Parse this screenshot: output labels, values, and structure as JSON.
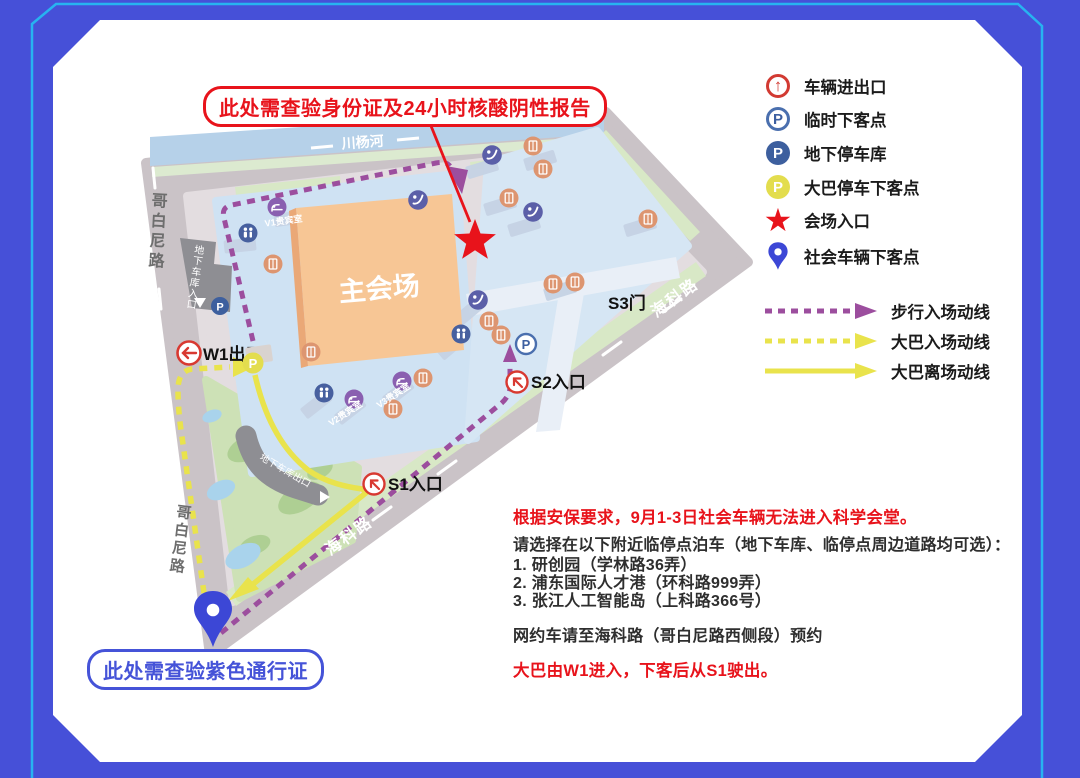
{
  "annotations": {
    "id_check": "此处需查验身份证及24小时核酸阴性报告",
    "pass_check": "此处需查验紫色通行证"
  },
  "map": {
    "river": "川杨河",
    "road_west_top": "哥白尼路",
    "road_west_bottom": "哥白尼路",
    "road_se_upper": "海科路",
    "road_se_lower": "海科路",
    "main_hall": "主会场",
    "w1": "W1出口",
    "s1": "S1入口",
    "s2": "S2入口",
    "s3": "S3门",
    "garage_in": "地下车库入口",
    "garage_out": "地下车库出口",
    "vip1": "V1贵宾室",
    "vip2": "V2贵宾室",
    "vip3": "V3贵宾室"
  },
  "icons": {
    "parking_letter": "P",
    "up_arrow": "↑",
    "star_glyph": "★",
    "names": [
      "vehicle-gate-icon",
      "temp-dropoff-icon",
      "underground-garage-icon",
      "bus-dropoff-icon",
      "venue-entrance-star-icon",
      "social-vehicle-pin-icon",
      "walk-route-arrow",
      "bus-in-route-arrow",
      "bus-out-route-arrow",
      "lounge-icon",
      "info-icon",
      "facility-icon",
      "escalator-icon",
      "map-pin-icon"
    ]
  },
  "legend": {
    "markers": [
      {
        "icon": "vehicle-gate-icon",
        "label": "车辆进出口"
      },
      {
        "icon": "temp-dropoff-icon",
        "label": "临时下客点"
      },
      {
        "icon": "underground-garage-icon",
        "label": "地下停车库"
      },
      {
        "icon": "bus-dropoff-icon",
        "label": "大巴停车下客点"
      },
      {
        "icon": "venue-entrance-star-icon",
        "label": "会场入口"
      },
      {
        "icon": "social-vehicle-pin-icon",
        "label": "社会车辆下客点"
      }
    ],
    "routes": [
      {
        "style": "dashed",
        "color": "#9c4e9e",
        "label": "步行入场动线"
      },
      {
        "style": "dashed",
        "color": "#e9e34c",
        "label": "大巴入场动线"
      },
      {
        "style": "solid",
        "color": "#e9e34c",
        "label": "大巴离场动线"
      }
    ]
  },
  "notice": {
    "security": "根据安保要求，9月1-3日社会车辆无法进入科学会堂。",
    "parking_intro": "请选择在以下附近临停点泊车（地下车库、临停点周边道路均可选）：",
    "parking_options": [
      "1. 研创园（学林路36弄）",
      "2. 浦东国际人才港（环科路999弄）",
      "3. 张江人工智能岛（上科路366号）"
    ],
    "ride_hailing": "网约车请至海科路（哥白尼路西侧段）预约",
    "bus_route": "大巴由W1进入，下客后从S1驶出。"
  },
  "colors": {
    "page_bg": "#4650d8",
    "accent_line": "#27b3f0",
    "red": "#e8131b",
    "blue": "#4553d8",
    "purple_route": "#9c4e9e",
    "yellow_route": "#e9e34c",
    "main_hall_fill": "#f7c695",
    "campus_fill": "#cfe2f3",
    "road_fill": "#cac3c7",
    "river_fill": "#b6d1e9",
    "park_fill": "#cde1b6"
  }
}
